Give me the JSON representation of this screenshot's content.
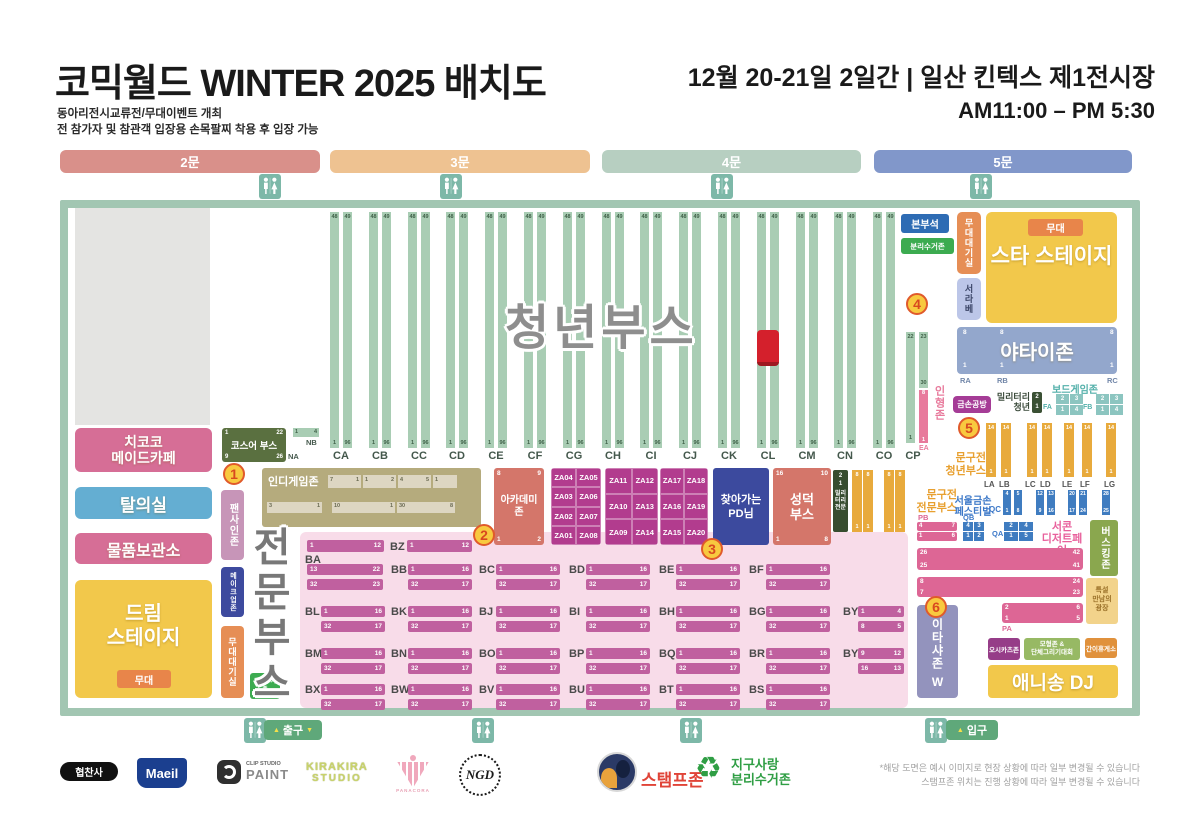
{
  "header": {
    "title": "코믹월드 WINTER 2025 배치도",
    "subtitle1": "동아리전시교류전/무대이벤트 개최",
    "subtitle2": "전 참가자 및 참관객 입장용 손목팔찌 착용 후 입장 가능",
    "date": "12월 20-21일 2일간 | 일산 킨텍스 제1전시장",
    "time": "AM11:00 – PM 5:30"
  },
  "gates": [
    {
      "label": "2문",
      "color": "#d9908a"
    },
    {
      "label": "3문",
      "color": "#eec291"
    },
    {
      "label": "4문",
      "color": "#b7cfc1"
    },
    {
      "label": "5문",
      "color": "#8197ca"
    }
  ],
  "markers": [
    "1",
    "2",
    "3",
    "4",
    "5",
    "6"
  ],
  "youth_booths": {
    "title": "청년부스",
    "column_ids": [
      "CA",
      "CB",
      "CC",
      "CD",
      "CE",
      "CF",
      "CG",
      "CH",
      "CI",
      "CJ",
      "CK",
      "CL",
      "CM",
      "CN",
      "CO"
    ],
    "top_numbers": [
      "48",
      "49"
    ],
    "bottom_numbers": [
      "1",
      "96"
    ],
    "cp": {
      "id": "CP",
      "top": [
        "22",
        "23"
      ],
      "mid": "30",
      "bottom": "1"
    },
    "na_label": "NA",
    "nb_label": "NB",
    "nb_numbers": [
      "1",
      "4"
    ]
  },
  "zones": {
    "hq": "본부석",
    "recycle_top": "분리수거존",
    "stage_wait_right": "무대대기실",
    "seorabe": "서라베",
    "stage_badge": "무대",
    "star_stage": "스타 스테이지",
    "yatai": "야타이존",
    "yatai_cols": [
      {
        "id": "RA",
        "top": "8",
        "bottom": "1"
      },
      {
        "id": "RB",
        "top": "8",
        "bottom": "1"
      },
      {
        "id": "RC",
        "top": "8",
        "bottom": "1"
      }
    ],
    "board_game": "보드게임존",
    "board_blocks": [
      {
        "id": "FA",
        "cells": [
          [
            "2",
            "3"
          ],
          [
            "1",
            "4"
          ]
        ]
      },
      {
        "id": "FB",
        "cells": [
          [
            "2",
            "3"
          ],
          [
            "1",
            "4"
          ]
        ]
      }
    ],
    "military_youth": {
      "line1": "밀리터리",
      "line2": "청년",
      "numbers": [
        "2",
        "1"
      ]
    },
    "geumson_gongbang": "금손공방",
    "doll_zone": {
      "label": "인형존",
      "column_id": "EA",
      "top": "8",
      "bottom": "1"
    },
    "stationery_youth": {
      "line1": "문구전",
      "line2": "청년부스",
      "columns": [
        {
          "id": "LA",
          "top": "14",
          "bottom": "1"
        },
        {
          "id": "LB",
          "top": "14",
          "bottom": "1"
        },
        {
          "id": "LC",
          "top": "14",
          "bottom": "1"
        },
        {
          "id": "LD",
          "top": "14",
          "bottom": "1"
        },
        {
          "id": "LE",
          "top": "14",
          "bottom": "1"
        },
        {
          "id": "LF",
          "top": "14",
          "bottom": "1"
        },
        {
          "id": "LG",
          "top": "14",
          "bottom": "1"
        }
      ]
    },
    "stationery_pro": {
      "line1": "문구전",
      "line2": "전문부스",
      "columns": [
        {
          "id": "KA",
          "top": "8",
          "bottom": "1"
        },
        {
          "id": "KB",
          "top": "8",
          "bottom": "1"
        },
        {
          "id": "KC",
          "top": "8",
          "bottom": "1"
        },
        {
          "id": "KD",
          "top": "8",
          "bottom": "1"
        }
      ]
    },
    "military_pro": {
      "lines": [
        "밀리",
        "터리",
        "전문"
      ],
      "numbers": [
        "2",
        "1"
      ]
    },
    "geumson_fest": {
      "line1": "서울금손",
      "line2": "페스티벌",
      "qc_label": "QC",
      "qc_cols": [
        [
          "4",
          "1"
        ],
        [
          "5",
          "8"
        ],
        [
          "12",
          "9"
        ],
        [
          "13",
          "16"
        ],
        [
          "20",
          "17"
        ],
        [
          "21",
          "24"
        ],
        [
          "28",
          "25"
        ]
      ],
      "qb": {
        "id": "QB",
        "cells": [
          [
            "4",
            "3"
          ],
          [
            "1",
            "2"
          ]
        ]
      },
      "qa": {
        "id": "QA",
        "cells": [
          [
            "2",
            "4"
          ],
          [
            "1",
            "5"
          ]
        ]
      },
      "pb": {
        "id": "PB",
        "rows": [
          [
            "4",
            "7"
          ],
          [
            "1",
            "6"
          ]
        ]
      }
    },
    "dessert_fair": {
      "line1": "서콘",
      "line2": "디저트페어",
      "rows": [
        {
          "tl": "26",
          "tr": "42",
          "bl": "25",
          "br": "41"
        },
        {
          "tl": "8",
          "tr": "24",
          "bl": "7",
          "br": "23"
        },
        {
          "id": "PA",
          "tl": "2",
          "tr": "6",
          "bl": "1",
          "br": "5"
        }
      ]
    },
    "busking": "버스킹존",
    "meeting_plaza": [
      "특설",
      "만남의",
      "광장"
    ],
    "itasha": {
      "label": "이타샤존",
      "suffix": "W"
    },
    "oshi_box": "오시카츠존",
    "model_zone": {
      "line1": "모형존 &",
      "line2": "단체그리기대회"
    },
    "rest_box": "간이휴게소",
    "anisong": "애니송 DJ",
    "maid_cafe": {
      "line1": "치코코",
      "line2": "메이드카페"
    },
    "fitting": "탈의실",
    "storage": "물품보관소",
    "dream_stage": {
      "line1": "드림",
      "line2": "스테이지",
      "stage": "무대"
    },
    "fan_sign": "팬사인존",
    "makeup": "메이크업존",
    "stage_wait_left": "무대대기실",
    "recycle_left": {
      "line1": "분리수거",
      "line2": "존"
    },
    "cosplay_booth": {
      "label": "코스어 부스",
      "tl": "1",
      "tr": "22",
      "bl": "9",
      "br": "26"
    },
    "indie_game": {
      "label": "인디게임존",
      "top_cells": [
        [
          "7",
          "1"
        ],
        [
          "1",
          "2"
        ],
        [
          "4",
          "5"
        ],
        [
          "1"
        ]
      ],
      "bottom_slats": [
        [
          "3",
          "1"
        ],
        [
          "10",
          "1"
        ],
        [
          "30",
          "8"
        ]
      ]
    },
    "academy": {
      "line1": "아카데미",
      "line2": "존",
      "tl": "8",
      "tr": "9",
      "bl": "1",
      "br": "2"
    },
    "za_blocks": [
      [
        [
          "ZA04",
          "ZA05"
        ],
        [
          "ZA03",
          "ZA06"
        ],
        [
          "ZA02",
          "ZA07"
        ],
        [
          "ZA01",
          "ZA08"
        ]
      ],
      [
        [
          "ZA11",
          "ZA12"
        ],
        [
          "ZA10",
          "ZA13"
        ],
        [
          "ZA09",
          "ZA14"
        ]
      ],
      [
        [
          "ZA17",
          "ZA18"
        ],
        [
          "ZA16",
          "ZA19"
        ],
        [
          "ZA15",
          "ZA20"
        ]
      ]
    ],
    "pd": {
      "line1": "찾아가는",
      "line2": "PD님"
    },
    "seongdeok": {
      "line1": "성덕",
      "line2": "부스",
      "tl": "16",
      "tr": "10",
      "bl": "1",
      "br": "8"
    }
  },
  "pro_booths": {
    "title": "전문부스",
    "ba": {
      "id": "BA",
      "top_slat": [
        "1",
        "12"
      ],
      "slats": [
        [
          "13",
          "22"
        ],
        [
          "32",
          "23"
        ]
      ]
    },
    "bz": {
      "id": "BZ",
      "slat": [
        "1",
        "12"
      ]
    },
    "default_slats": [
      [
        "1",
        "16"
      ],
      [
        "32",
        "17"
      ]
    ],
    "row1": [
      "BB",
      "BC",
      "BD",
      "BE",
      "BF"
    ],
    "row2": [
      "BL",
      "BK",
      "BJ",
      "BI",
      "BH",
      "BG"
    ],
    "row2_by": {
      "id": "BY",
      "slats": [
        [
          "1",
          "4"
        ],
        [
          "8",
          "5"
        ]
      ]
    },
    "row3": [
      "BM",
      "BN",
      "BO",
      "BP",
      "BQ",
      "BR"
    ],
    "row3_by": {
      "id": "BY",
      "slats": [
        [
          "9",
          "12"
        ],
        [
          "16",
          "13"
        ]
      ]
    },
    "row4": [
      "BX",
      "BW",
      "BV",
      "BU",
      "BT",
      "BS"
    ]
  },
  "badges": {
    "exit": "출구",
    "entry": "입구",
    "arrow_up": "▲",
    "arrow_down": "▼"
  },
  "footer": {
    "sponsor_label": "협찬사",
    "maeil": "Maeil",
    "clip_small": "CLIP STUDIO",
    "clip_big": "PAINT",
    "kirakira1": "KIRAKIRA",
    "kirakira2": "STUDIO",
    "panacora": "PANACORA",
    "monogram": "NGD",
    "stamp_zone": "스탬프존",
    "earth1": "지구사랑",
    "earth2": "분리수거존",
    "recycle_glyph": "♻",
    "notice1": "*해당 도면은 예시 이미지로 현장 상황에 따라 일부 변경될 수 있습니다",
    "notice2": "스탬프존 위치는 진행 상황에 따라 일부 변경될 수 있습니다"
  },
  "colors": {
    "map_border": "#a2c6b2",
    "youth_column": "#a9cdb4",
    "red_marker": "#d4202c",
    "yellow_stage": "#f2c84b",
    "orange_badge": "#e8854a",
    "yatai_blue": "#93a7cc",
    "pink_booth": "#d66e96",
    "magenta_za": "#b23c8e",
    "pro_slat": "#c0609f",
    "pro_bg": "#f8dce9",
    "orange_col": "#e8aa3c",
    "blue_col": "#3f7cc0",
    "dessert_pink": "#dd6695",
    "busking_olive": "#8aa74e",
    "itasha_purple": "#9393bd",
    "teal_toilet": "#7db8a8",
    "exit_green": "#5fa87a"
  }
}
